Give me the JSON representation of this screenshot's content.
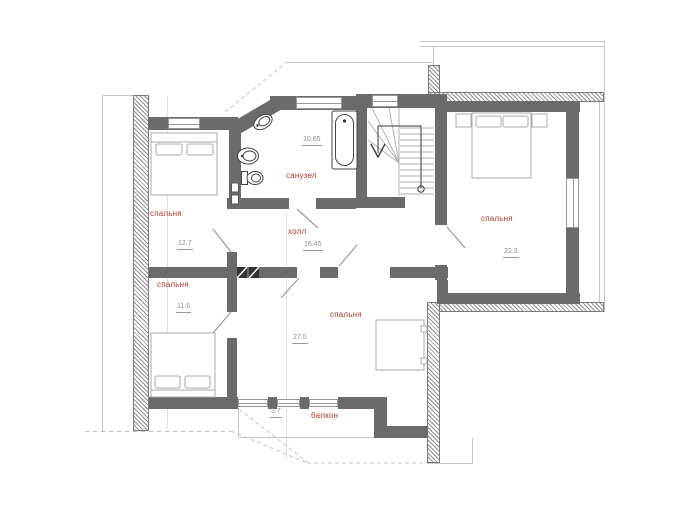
{
  "plan": {
    "rooms": [
      {
        "name": "спальня",
        "area": "12.7"
      },
      {
        "name": "санузел",
        "area": "10.65"
      },
      {
        "name": "холл",
        "area": "16.45"
      },
      {
        "name": "спальня",
        "area": "22.3"
      },
      {
        "name": "спальня",
        "area": "11.6"
      },
      {
        "name": "спальня",
        "area": "27.0"
      },
      {
        "name": "балкон",
        "area": "3.7"
      }
    ],
    "colors": {
      "wall": "#6b6b6b",
      "room_label": "#ae382e",
      "area_value": "#8e8e8e",
      "exterior_hatch": "#8f8f8f"
    }
  }
}
